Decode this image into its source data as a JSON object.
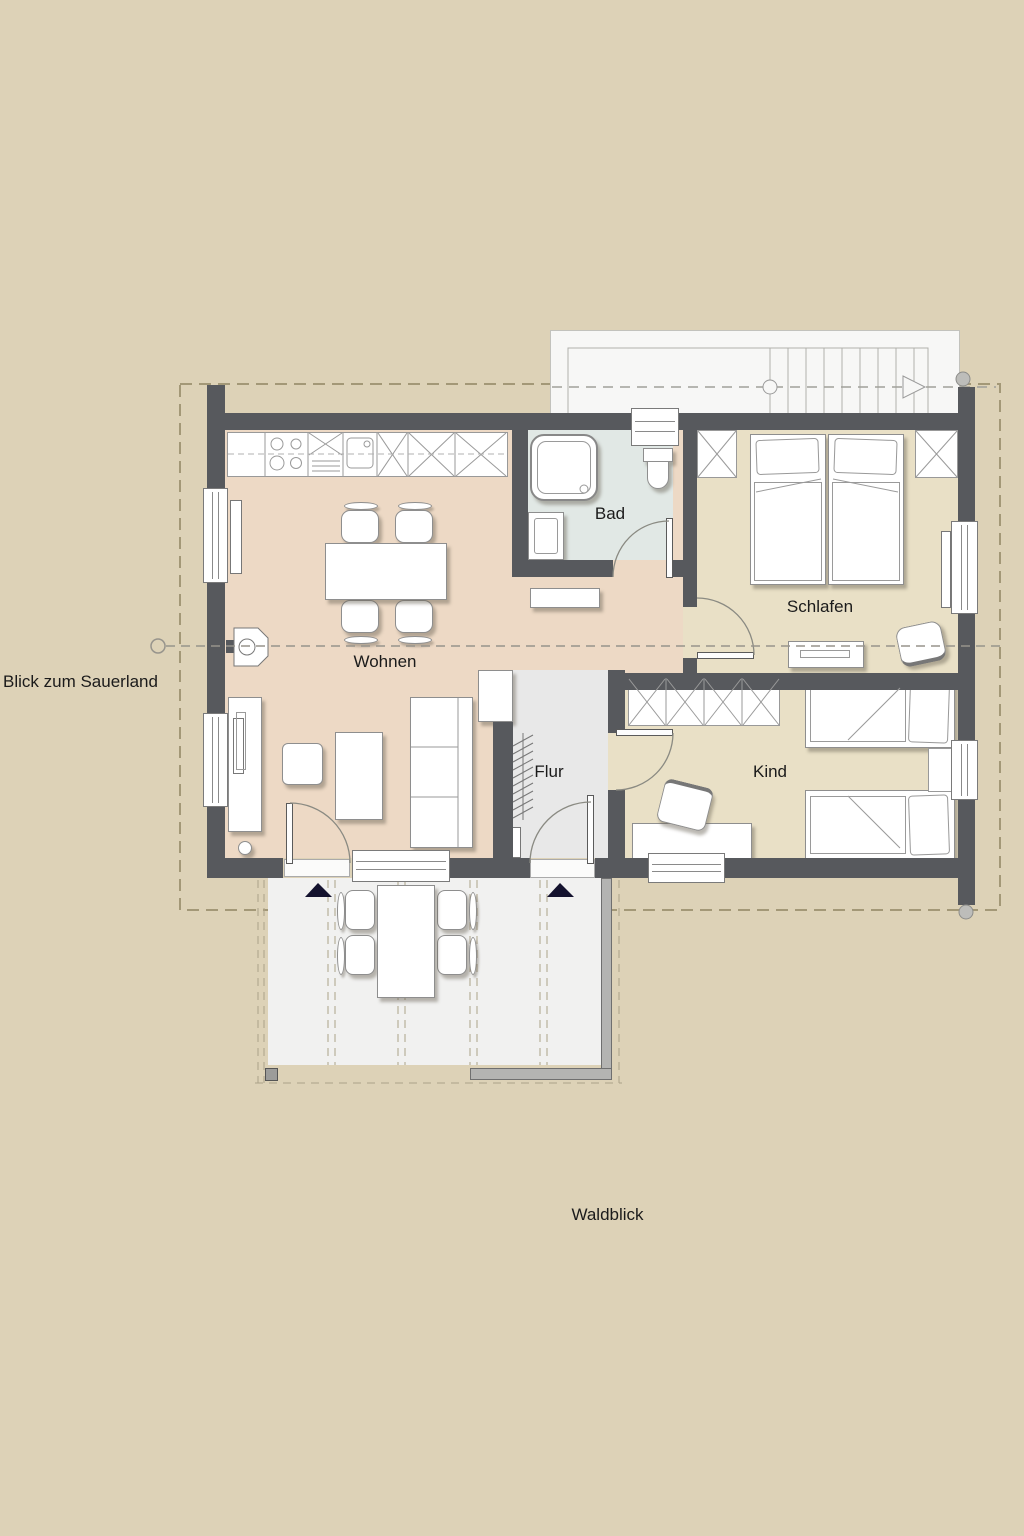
{
  "plan": {
    "type": "apartment-floor-plan",
    "rooms": {
      "wohnen": {
        "label": "Wohnen"
      },
      "bad": {
        "label": "Bad"
      },
      "schlafen": {
        "label": "Schlafen"
      },
      "kind": {
        "label": "Kind"
      },
      "flur": {
        "label": "Flur"
      }
    },
    "view_labels": {
      "left": "Blick zum Sauerland",
      "bottom": "Waldblick"
    },
    "colors": {
      "background": "#ddd2b7",
      "wall": "#57595d",
      "floor_wohnen": "#edd9c5",
      "floor_bad": "#e1e8e5",
      "floor_bedrooms": "#e9e0c6",
      "floor_flur": "#e8e8e8",
      "terrace": "#f1f1f0",
      "stair_area": "#f7f7f6",
      "roof_dash": "#a39877",
      "entrance_marker": "#14122e"
    }
  }
}
